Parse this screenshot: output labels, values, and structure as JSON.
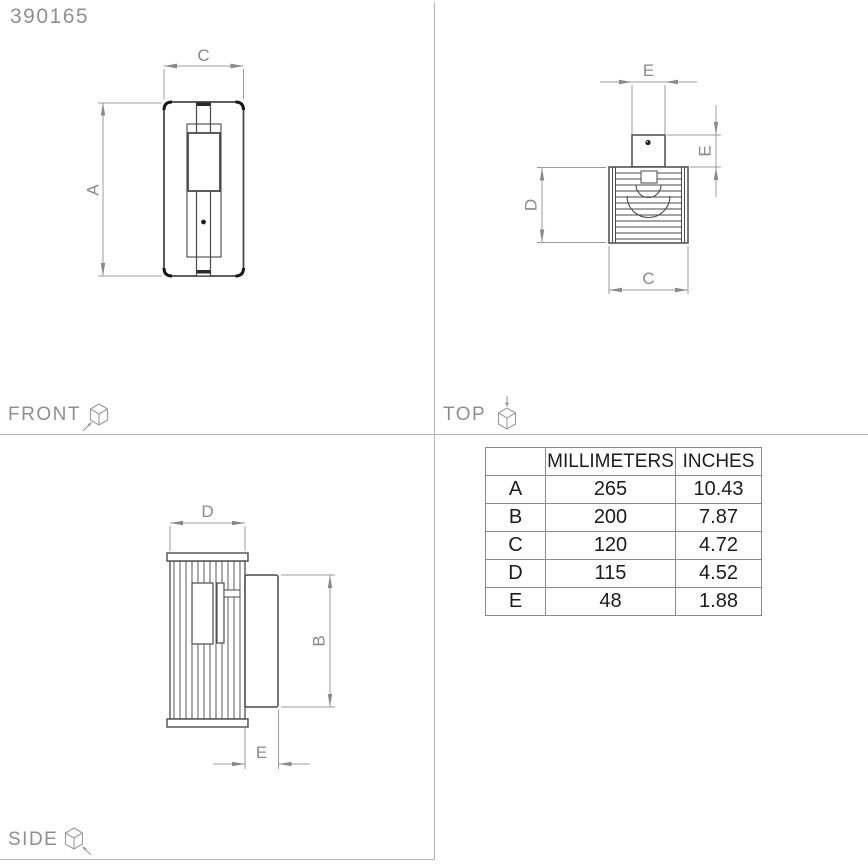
{
  "product_code": "390165",
  "views": {
    "front": {
      "label": "FRONT"
    },
    "top": {
      "label": "TOP"
    },
    "side": {
      "label": "SIDE"
    }
  },
  "dims": {
    "A": "A",
    "B": "B",
    "C": "C",
    "D": "D",
    "E": "E"
  },
  "table": {
    "headers": [
      "",
      "MILLIMETERS",
      "INCHES"
    ],
    "rows": [
      {
        "key": "A",
        "mm": "265",
        "inches": "10.43"
      },
      {
        "key": "B",
        "mm": "200",
        "inches": "7.87"
      },
      {
        "key": "C",
        "mm": "120",
        "inches": "4.72"
      },
      {
        "key": "D",
        "mm": "115",
        "inches": "4.52"
      },
      {
        "key": "E",
        "mm": "48",
        "inches": "1.88"
      }
    ]
  },
  "colors": {
    "background": "#ffffff",
    "object_line": "#4a4a4a",
    "object_dark": "#161616",
    "dimension_line": "#9c9c9c",
    "label_gray": "#8f8f8f",
    "table_border": "#8a8a8a",
    "table_text": "#1c1c1c",
    "divider": "#b5b5b5"
  }
}
